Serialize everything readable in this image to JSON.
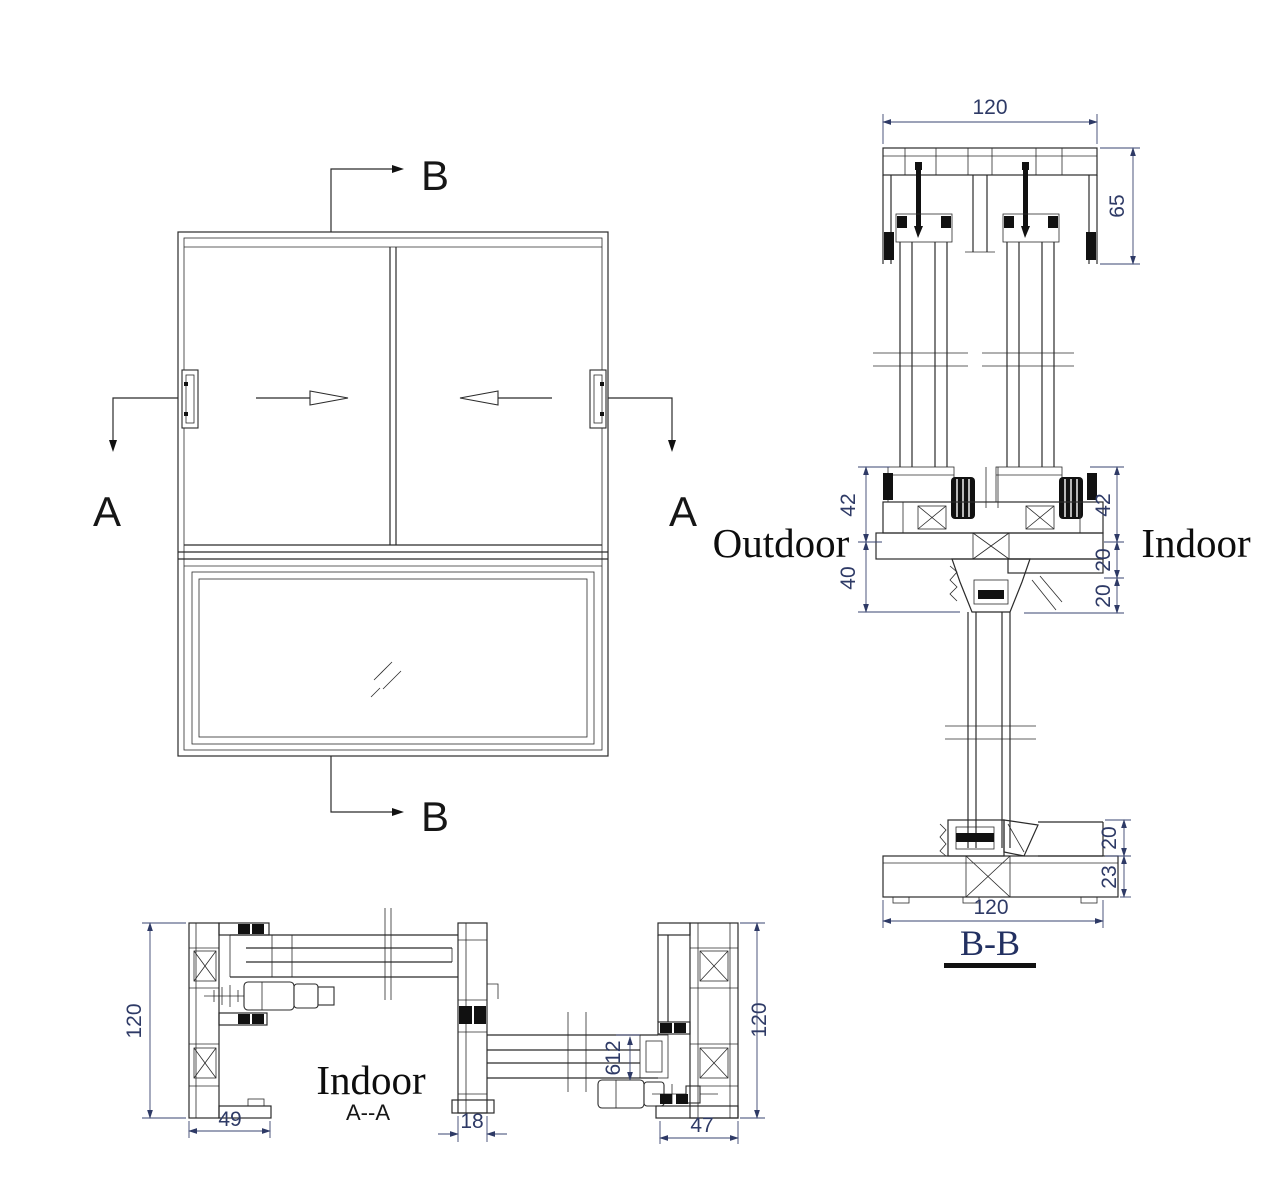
{
  "elevation": {
    "marker_b_top": "B",
    "marker_b_bottom": "B",
    "marker_a_left": "A",
    "marker_a_right": "A"
  },
  "section_bb": {
    "title": "B-B",
    "outdoor_label": "Outdoor",
    "indoor_label": "Indoor",
    "dims": {
      "head_width": "120",
      "head_height": "65",
      "left_upper": "42",
      "left_lower": "40",
      "right_upper": "42",
      "right_mid_a": "20",
      "right_mid_b": "20",
      "sill_upper": "20",
      "sill_lower": "23",
      "sill_width": "120"
    }
  },
  "section_aa": {
    "title": "A--A",
    "indoor_label": "Indoor",
    "dims": {
      "left_depth": "120",
      "left_width": "49",
      "interlock_width": "18",
      "glass_dim": "612",
      "right_depth": "120",
      "right_width": "47"
    }
  }
}
